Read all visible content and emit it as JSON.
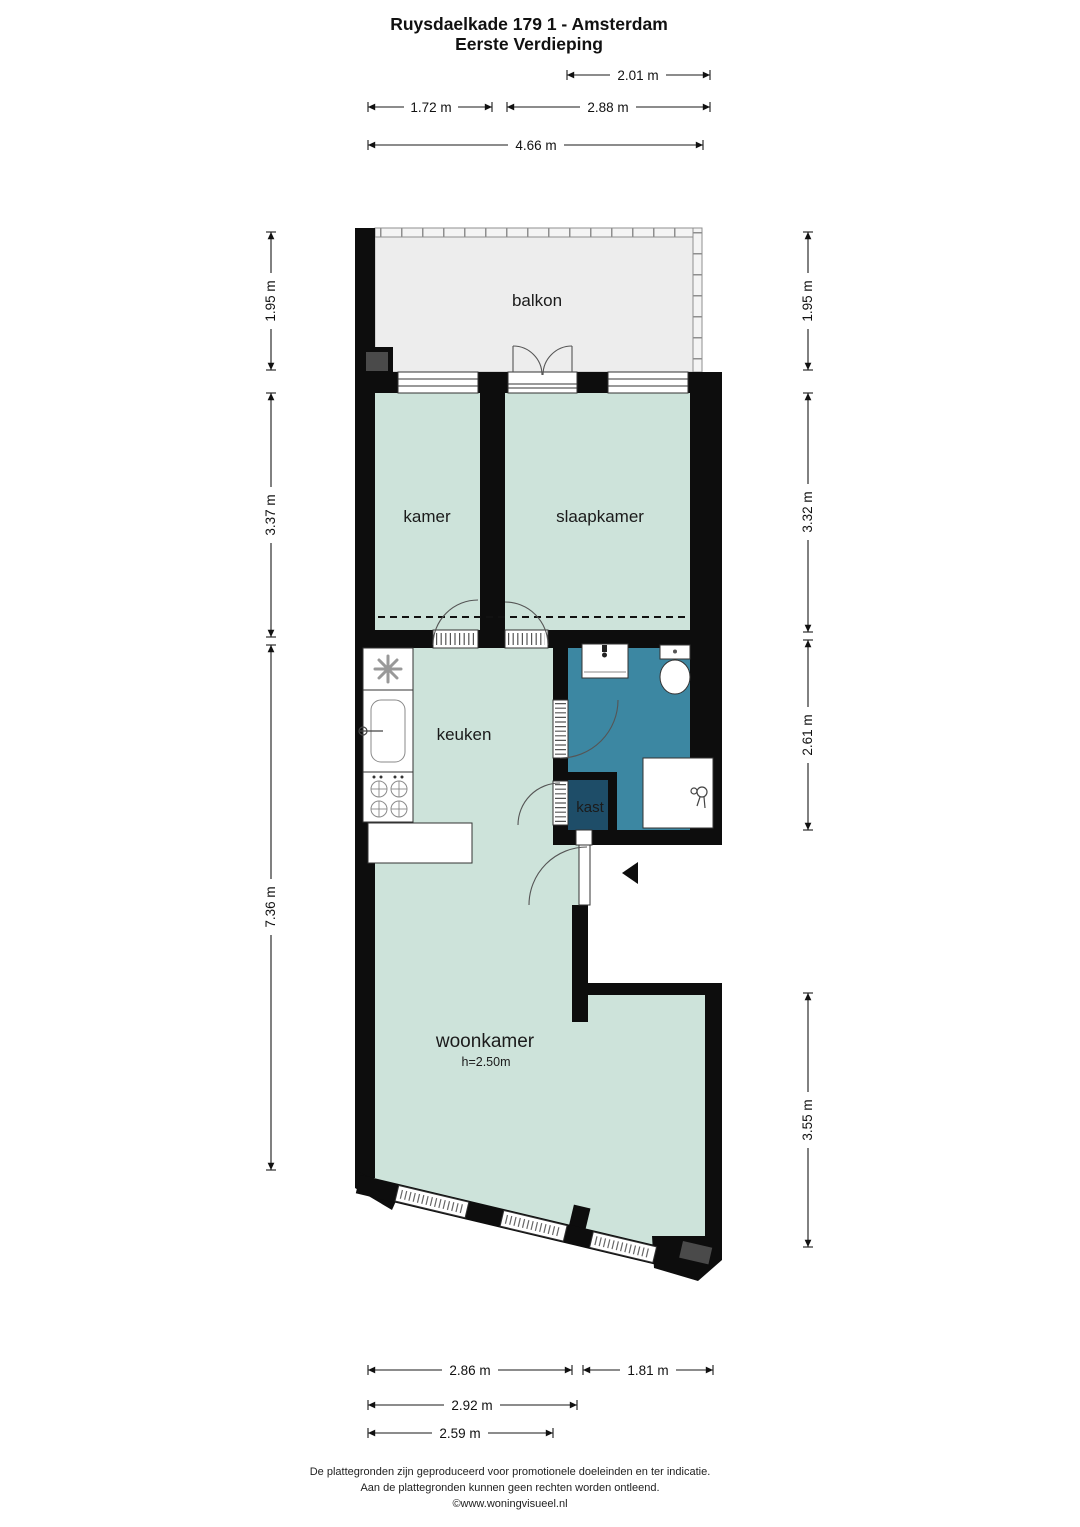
{
  "title": {
    "line1": "Ruysdaelkade 179 1 - Amsterdam",
    "line2": "Eerste Verdieping"
  },
  "rooms": {
    "balkon": {
      "label": "balkon"
    },
    "kamer": {
      "label": "kamer"
    },
    "slaapkamer": {
      "label": "slaapkamer"
    },
    "keuken": {
      "label": "keuken"
    },
    "kast": {
      "label": "kast"
    },
    "woonkamer": {
      "label": "woonkamer",
      "ceiling_height": "h=2.50m"
    }
  },
  "dimensions": {
    "top": [
      "2.01 m",
      "1.72 m",
      "2.88 m",
      "4.66 m"
    ],
    "left": [
      "1.95 m",
      "3.37 m",
      "7.36 m"
    ],
    "right": [
      "1.95 m",
      "3.32 m",
      "2.61 m",
      "3.55 m"
    ],
    "bottom": [
      "2.86 m",
      "1.81 m",
      "2.92 m",
      "2.59 m"
    ]
  },
  "footer": {
    "line1": "De plattegronden zijn geproduceerd voor promotionele doeleinden en ter indicatie.",
    "line2": "Aan de plattegronden kunnen geen rechten worden ontleend.",
    "line3": "©www.woningvisueel.nl"
  },
  "colors": {
    "wall": "#0d0d0d",
    "room_fill": "#cde3da",
    "bathroom_fill": "#3c87a2",
    "closet_fill": "#1e4d68",
    "balcony_fill": "#ededed"
  }
}
